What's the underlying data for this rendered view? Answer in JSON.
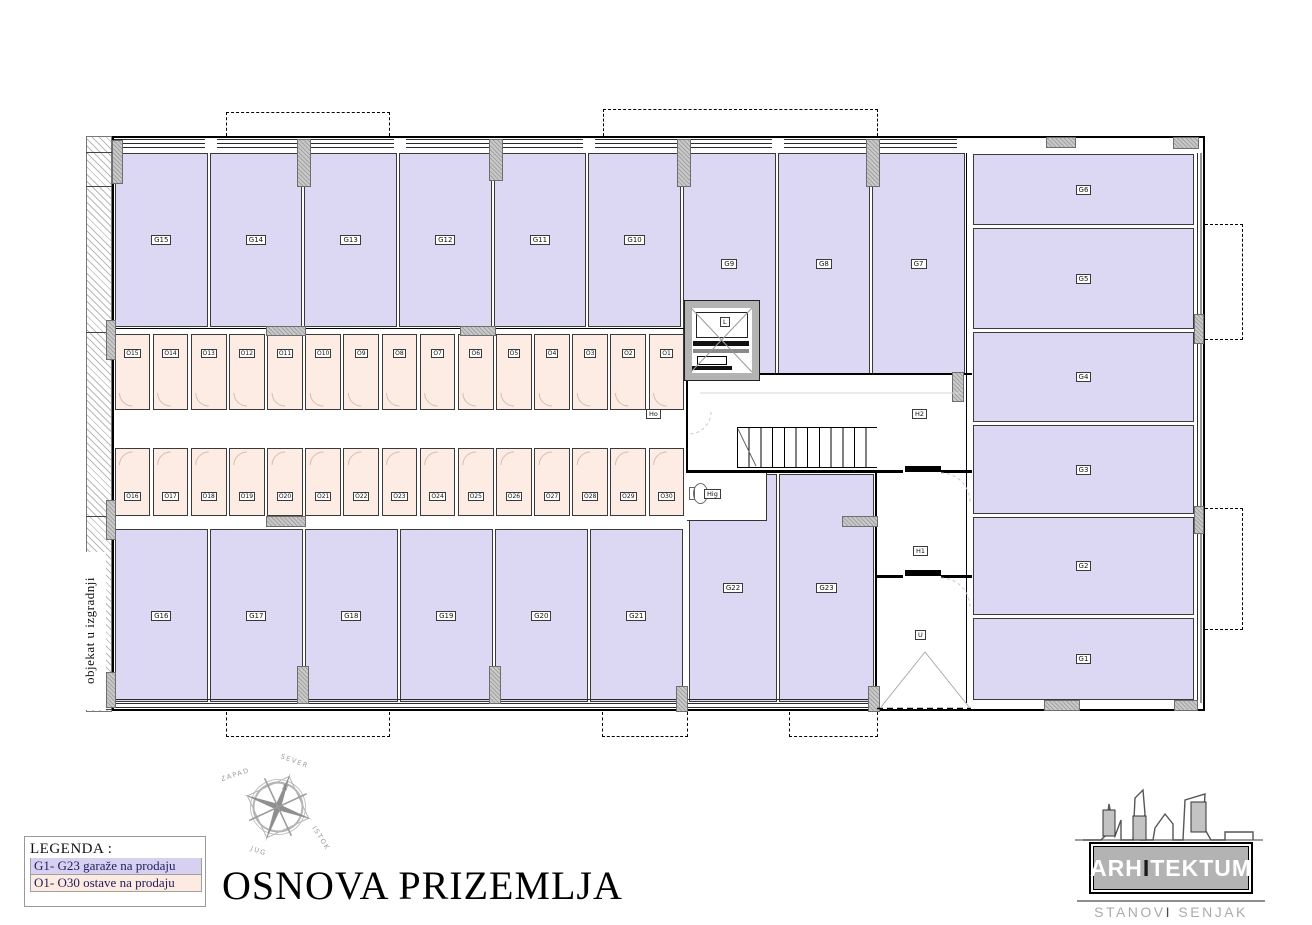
{
  "title": "OSNOVA PRIZEMLJA",
  "side_note": "objekat u izgradnji",
  "legend": {
    "heading": "LEGENDA :",
    "items": [
      {
        "label": "G1- G23 garaže na prodaju",
        "color": "#d7d0f1"
      },
      {
        "label": "O1- O30 ostave na prodaju",
        "color": "#fdeae1"
      }
    ]
  },
  "compass": {
    "n": "N",
    "north": "SEVER",
    "south": "JUG",
    "east": "ISTOK",
    "west": "ZAPAD"
  },
  "logo": {
    "name_part1": "ARH",
    "name_accent": "I",
    "name_part2": "TEKTUM",
    "subtitle_part1": "STANOV",
    "subtitle_accent": "I",
    "subtitle_part2": " SENJAK"
  },
  "rooms": {
    "top_garages": [
      "G15",
      "G14",
      "G13",
      "G12",
      "G11",
      "G10",
      "G9",
      "G8",
      "G7"
    ],
    "right_garages": [
      "G6",
      "G5",
      "G4",
      "G3",
      "G2",
      "G1"
    ],
    "bottom_garages": [
      "G16",
      "G17",
      "G18",
      "G19",
      "G20",
      "G21",
      "G22",
      "G23"
    ],
    "storage_top": [
      "O15",
      "O14",
      "O13",
      "O12",
      "O11",
      "O10",
      "O9",
      "O8",
      "O7",
      "O6",
      "O5",
      "O4",
      "O3",
      "O2",
      "O1"
    ],
    "storage_bottom": [
      "O16",
      "O17",
      "O18",
      "O19",
      "O20",
      "O21",
      "O22",
      "O23",
      "O24",
      "O25",
      "O26",
      "O27",
      "O28",
      "O29",
      "O30"
    ],
    "halls": {
      "corridor": "Ho",
      "stair_hall": "H2",
      "lobby": "H1",
      "entrance": "U",
      "wc": "Hig",
      "elevator": "L"
    }
  },
  "colors": {
    "garage_fill": "#dcd7f3",
    "storage_fill": "#fdece4",
    "column_fill": "#bdbdbd",
    "wall": "#000000"
  }
}
